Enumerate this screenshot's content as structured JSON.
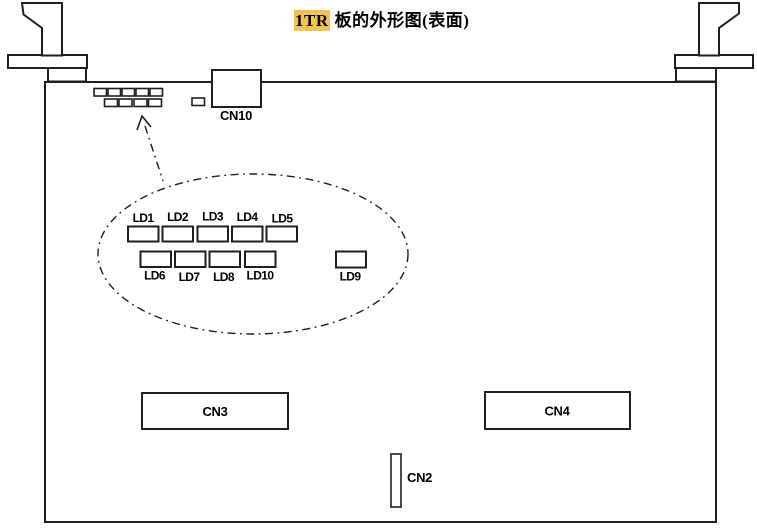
{
  "title": {
    "highlight": "1TR",
    "rest": "板的外形图(表面)"
  },
  "connectors": {
    "cn10": {
      "label": "CN10"
    },
    "cn3": {
      "label": "CN3"
    },
    "cn4": {
      "label": "CN4"
    },
    "cn2": {
      "label": "CN2"
    }
  },
  "leds": {
    "top": [
      {
        "label": "LD1"
      },
      {
        "label": "LD2"
      },
      {
        "label": "LD3"
      },
      {
        "label": "LD4"
      },
      {
        "label": "LD5"
      }
    ],
    "bottom": [
      {
        "label": "LD6"
      },
      {
        "label": "LD7"
      },
      {
        "label": "LD8"
      },
      {
        "label": "LD10"
      }
    ],
    "separate": {
      "label": "LD9"
    }
  },
  "colors": {
    "line": "#1f1f1f",
    "text": "#000000",
    "highlight": "#f2c352",
    "bg": "#ffffff"
  }
}
